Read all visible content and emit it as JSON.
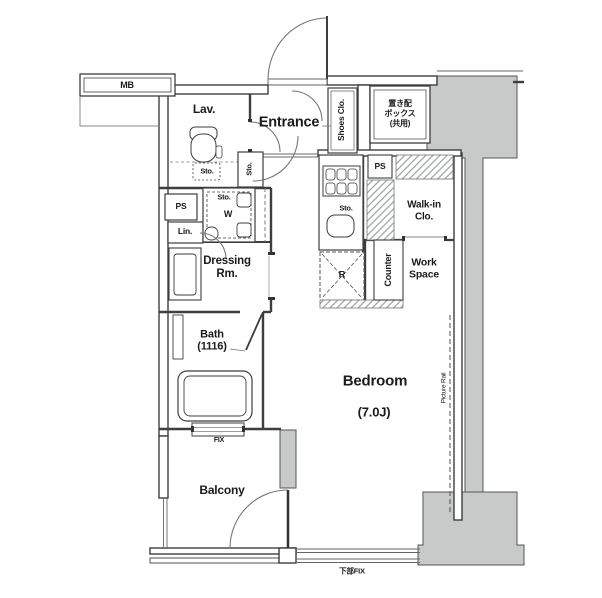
{
  "plan": {
    "title": "apartment-floor-plan",
    "labels": {
      "mb": "MB",
      "lav": "Lav.",
      "sto_lav": "Sto.",
      "entrance": "Entrance",
      "shoes_closet": "Shoes Clo.",
      "delivery_box": "置き配\nボックス\n(共用)",
      "ps_right": "PS",
      "walk_in_closet": "Walk-in\nClo.",
      "sto_entrance": "Sto.",
      "sto_closet": "Sto.",
      "washer": "W",
      "ps_left": "PS",
      "linen": "Lin.",
      "dressing_room": "Dressing\nRm.",
      "bath": "Bath\n(1116)",
      "sto_kitchen": "Sto.",
      "refrigerator": "R",
      "counter": "Counter",
      "work_space": "Work\nSpace",
      "bedroom": "Bedroom",
      "bedroom_size": "(7.0J)",
      "picture_rail": "Picture Rail",
      "fix_window": "FIX",
      "balcony": "Balcony",
      "bottom_fix_window": "下部FIX"
    },
    "colors": {
      "wall": "#3e3e3e",
      "thin_line": "#666666",
      "structure_fill": "#c7cac8",
      "structure_stroke": "#555555",
      "text": "#1b1b1b",
      "background": "#ffffff"
    }
  }
}
